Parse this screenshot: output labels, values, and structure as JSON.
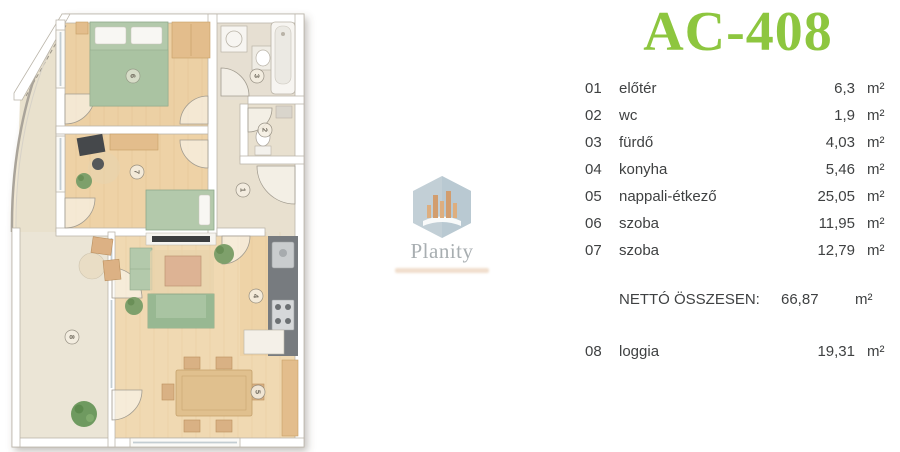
{
  "title": "AC-408",
  "colors": {
    "accent_green": "#8dc63f",
    "text_gray": "#3f4142",
    "watermark_gray": "#99a0a4",
    "watermark_orange": "#d9a97c",
    "floor_wood": "#ecd0a4",
    "floor_pale": "#ebe5d6",
    "furniture_green": "#aec7a6"
  },
  "legend": {
    "rows": [
      {
        "num": "01",
        "name": "előtér",
        "area": "6,3",
        "unit": "m²"
      },
      {
        "num": "02",
        "name": "wc",
        "area": "1,9",
        "unit": "m²"
      },
      {
        "num": "03",
        "name": "fürdő",
        "area": "4,03",
        "unit": "m²"
      },
      {
        "num": "04",
        "name": "konyha",
        "area": "5,46",
        "unit": "m²"
      },
      {
        "num": "05",
        "name": "nappali-étkező",
        "area": "25,05",
        "unit": "m²"
      },
      {
        "num": "06",
        "name": "szoba",
        "area": "11,95",
        "unit": "m²"
      },
      {
        "num": "07",
        "name": "szoba",
        "area": "12,79",
        "unit": "m²"
      }
    ],
    "total": {
      "label": "NETTÓ ÖSSZESEN:",
      "area": "66,87",
      "unit": "m²"
    },
    "extra": [
      {
        "num": "08",
        "name": "loggia",
        "area": "19,31",
        "unit": "m²"
      }
    ]
  },
  "watermark": {
    "name": "Planity"
  },
  "plan": {
    "room_labels": {
      "eloter": "1",
      "wc": "2",
      "furdo": "3",
      "konyha": "4",
      "nappali": "5",
      "szoba_a": "6",
      "szoba_b": "7",
      "loggia": "8"
    }
  }
}
